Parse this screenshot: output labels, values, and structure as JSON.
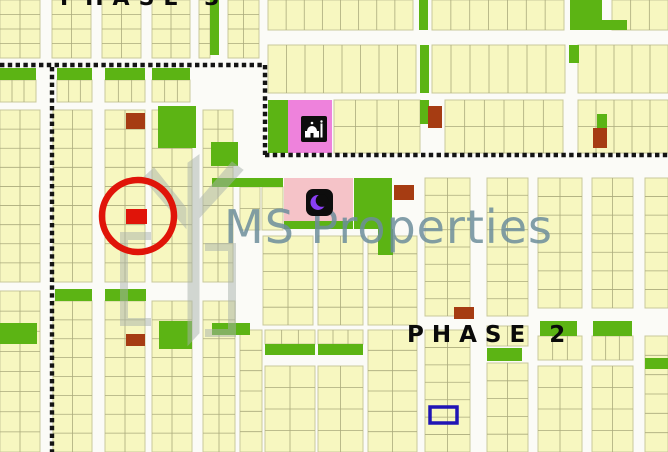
{
  "labels": {
    "phase_top": "PHASE 3",
    "phase2": "PHASE 2"
  },
  "watermark": {
    "text": "MS Properties"
  },
  "colors": {
    "road": "#fbfbf7",
    "plot_fill": "#f7f7c0",
    "plot_line": "#aaaa7c",
    "block_edge": "#c9c99b",
    "green": "#5cb414",
    "brown": "#a63c12",
    "magenta_pink": "#ee82dc",
    "light_pink": "#f5c3c8",
    "red": "#e01409",
    "blue": "#2015b5",
    "dotted": "#141414",
    "icon_bg": "#0d0d0d",
    "icon_glyph": "#ffffff",
    "crescent_purple": "#8a3ff5",
    "watermark_text": "#6d8e9c",
    "watermark_logo": "#a9b2ac",
    "phase_text": "#0a0a0a"
  },
  "map": {
    "blocks": [
      [
        0,
        0,
        40,
        58,
        4,
        2
      ],
      [
        52,
        0,
        39,
        58,
        4,
        2
      ],
      [
        102,
        0,
        39,
        58,
        4,
        2
      ],
      [
        152,
        0,
        38,
        58,
        4,
        2
      ],
      [
        199,
        0,
        11,
        58,
        4,
        1
      ],
      [
        228,
        0,
        31,
        58,
        4,
        2
      ],
      [
        268,
        0,
        145,
        30,
        1,
        8
      ],
      [
        432,
        0,
        132,
        30,
        1,
        7
      ],
      [
        612,
        0,
        56,
        30,
        1,
        3
      ],
      [
        268,
        45,
        148,
        48,
        1,
        8
      ],
      [
        432,
        45,
        133,
        48,
        1,
        7
      ],
      [
        578,
        45,
        90,
        48,
        1,
        5
      ],
      [
        0,
        80,
        36,
        22,
        1,
        3
      ],
      [
        57,
        80,
        35,
        22,
        1,
        3
      ],
      [
        105,
        80,
        40,
        22,
        1,
        3
      ],
      [
        152,
        80,
        38,
        22,
        1,
        3
      ],
      [
        334,
        100,
        86,
        53,
        2,
        4
      ],
      [
        445,
        100,
        118,
        53,
        2,
        6
      ],
      [
        578,
        100,
        90,
        53,
        2,
        5
      ],
      [
        0,
        110,
        40,
        172,
        9,
        2
      ],
      [
        53,
        110,
        39,
        172,
        9,
        2
      ],
      [
        105,
        110,
        40,
        172,
        9,
        2
      ],
      [
        152,
        110,
        40,
        172,
        9,
        2
      ],
      [
        203,
        110,
        30,
        172,
        9,
        2
      ],
      [
        240,
        187,
        20,
        43,
        2,
        1
      ],
      [
        262,
        187,
        21,
        43,
        2,
        1
      ],
      [
        425,
        178,
        45,
        138,
        8,
        2
      ],
      [
        487,
        178,
        41,
        138,
        8,
        2
      ],
      [
        538,
        178,
        44,
        130,
        7,
        2
      ],
      [
        592,
        178,
        41,
        130,
        7,
        2
      ],
      [
        645,
        178,
        23,
        130,
        7,
        1
      ],
      [
        263,
        236,
        50,
        89,
        5,
        2
      ],
      [
        318,
        236,
        45,
        89,
        5,
        2
      ],
      [
        368,
        236,
        49,
        89,
        5,
        2
      ],
      [
        0,
        291,
        40,
        161,
        8,
        2
      ],
      [
        53,
        301,
        39,
        151,
        8,
        2
      ],
      [
        105,
        301,
        40,
        151,
        8,
        2
      ],
      [
        152,
        301,
        40,
        151,
        8,
        2
      ],
      [
        203,
        301,
        32,
        151,
        8,
        2
      ],
      [
        240,
        330,
        22,
        122,
        6,
        1
      ],
      [
        265,
        330,
        50,
        14,
        1,
        3
      ],
      [
        318,
        330,
        45,
        14,
        1,
        3
      ],
      [
        265,
        366,
        50,
        86,
        4,
        2
      ],
      [
        318,
        366,
        45,
        86,
        4,
        2
      ],
      [
        368,
        330,
        49,
        122,
        6,
        2
      ],
      [
        425,
        330,
        45,
        122,
        7,
        2
      ],
      [
        487,
        326,
        41,
        20,
        1,
        2
      ],
      [
        487,
        363,
        41,
        89,
        5,
        2
      ],
      [
        538,
        336,
        44,
        24,
        1,
        3
      ],
      [
        592,
        336,
        41,
        24,
        1,
        3
      ],
      [
        538,
        366,
        44,
        86,
        4,
        2
      ],
      [
        592,
        366,
        41,
        86,
        4,
        2
      ],
      [
        645,
        336,
        23,
        116,
        6,
        1
      ]
    ],
    "green_plots": [
      [
        210,
        0,
        9,
        55
      ],
      [
        419,
        0,
        9,
        30
      ],
      [
        570,
        0,
        32,
        30
      ],
      [
        602,
        20,
        25,
        10
      ],
      [
        0,
        68,
        36,
        12
      ],
      [
        57,
        68,
        35,
        12
      ],
      [
        105,
        68,
        40,
        12
      ],
      [
        152,
        68,
        38,
        12
      ],
      [
        420,
        45,
        9,
        48
      ],
      [
        569,
        45,
        10,
        18
      ],
      [
        268,
        100,
        20,
        53
      ],
      [
        420,
        100,
        9,
        24
      ],
      [
        597,
        114,
        10,
        14
      ],
      [
        158,
        106,
        38,
        42
      ],
      [
        211,
        142,
        27,
        24
      ],
      [
        212,
        178,
        71,
        9
      ],
      [
        284,
        221,
        69,
        8
      ],
      [
        354,
        178,
        38,
        51
      ],
      [
        378,
        229,
        15,
        26
      ],
      [
        0,
        323,
        37,
        21
      ],
      [
        55,
        289,
        37,
        12
      ],
      [
        105,
        289,
        41,
        12
      ],
      [
        159,
        321,
        33,
        28
      ],
      [
        212,
        323,
        38,
        12
      ],
      [
        540,
        321,
        37,
        15
      ],
      [
        593,
        321,
        39,
        15
      ],
      [
        265,
        344,
        50,
        11
      ],
      [
        318,
        344,
        45,
        11
      ],
      [
        487,
        348,
        35,
        13
      ],
      [
        645,
        358,
        23,
        11
      ]
    ],
    "brown_plots": [
      [
        126,
        113,
        19,
        16
      ],
      [
        428,
        106,
        14,
        22
      ],
      [
        593,
        128,
        14,
        20
      ],
      [
        394,
        185,
        20,
        15
      ],
      [
        454,
        307,
        20,
        12
      ],
      [
        126,
        334,
        19,
        12
      ]
    ],
    "pink_areas": [
      {
        "rect": [
          288,
          100,
          44,
          53
        ],
        "color": "magenta_pink"
      },
      {
        "rect": [
          284,
          178,
          69,
          43
        ],
        "color": "light_pink"
      }
    ],
    "boundary_dotted_lines": [
      [
        0,
        65,
        265,
        65
      ],
      [
        265,
        65,
        265,
        155
      ],
      [
        265,
        155,
        668,
        155
      ],
      [
        52,
        67,
        52,
        452
      ]
    ],
    "markers": {
      "highlight_circle": {
        "cx": 138,
        "cy": 216,
        "r": 36
      },
      "highlight_plot": [
        126,
        209,
        21,
        15
      ],
      "outlined_plot": [
        430,
        407,
        27,
        16
      ]
    },
    "icons": [
      {
        "name": "mosque-icon",
        "x": 301,
        "y": 116
      },
      {
        "name": "crescent-moon-icon",
        "x": 306,
        "y": 189
      }
    ]
  }
}
